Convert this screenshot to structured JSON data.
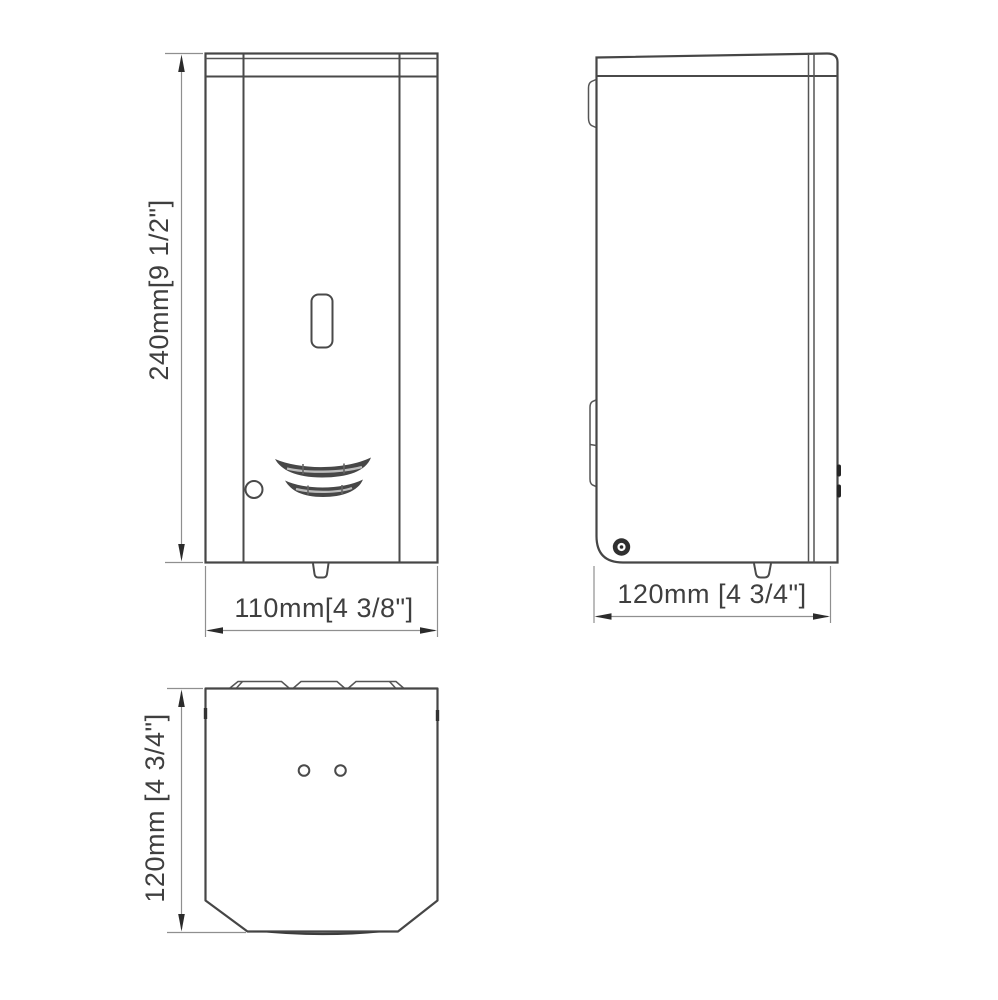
{
  "page": {
    "background": "#ffffff"
  },
  "drawing": {
    "type": "technical-orthographic-views",
    "line_color": "#464646",
    "dim_line_color": "#8f8f8f",
    "text_color": "#3f3f3f",
    "views": {
      "front": {
        "height_dim": "240mm[9 1/2\"]",
        "width_dim": "110mm[4 3/8\"]"
      },
      "side": {
        "depth_dim": "120mm [4 3/4\"]"
      },
      "bottom": {
        "depth_dim": "120mm [4 3/4\"]"
      }
    }
  }
}
